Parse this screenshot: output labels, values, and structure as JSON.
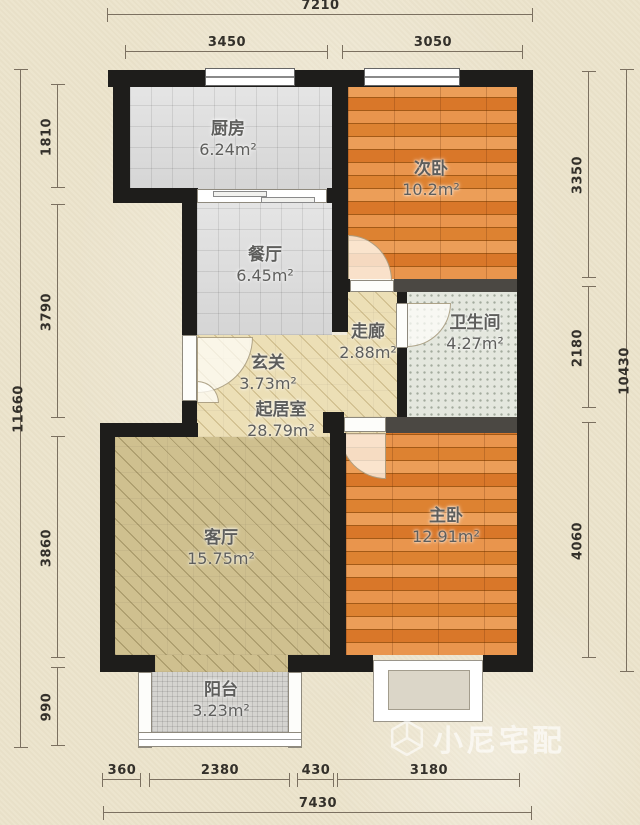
{
  "watermark": {
    "text": "小尼宅配",
    "icon": "cube-logo-icon"
  },
  "rooms": [
    {
      "key": "kitchen",
      "name": "厨房",
      "area": "6.24m²"
    },
    {
      "key": "second-bedroom",
      "name": "次卧",
      "area": "10.2m²"
    },
    {
      "key": "dining",
      "name": "餐厅",
      "area": "6.45m²"
    },
    {
      "key": "corridor",
      "name": "走廊",
      "area": "2.88m²"
    },
    {
      "key": "bathroom",
      "name": "卫生间",
      "area": "4.27m²"
    },
    {
      "key": "entry",
      "name": "玄关",
      "area": "3.73m²"
    },
    {
      "key": "hall",
      "name": "起居室",
      "area": "28.79m²"
    },
    {
      "key": "living",
      "name": "客厅",
      "area": "15.75m²"
    },
    {
      "key": "master-bedroom",
      "name": "主卧",
      "area": "12.91m²"
    },
    {
      "key": "balcony",
      "name": "阳台",
      "area": "3.23m²"
    }
  ],
  "dimensions": {
    "top": {
      "overall": "7210",
      "segments": [
        "3450",
        "3050"
      ]
    },
    "bottom": {
      "overall": "7430",
      "segments": [
        "360",
        "2380",
        "430",
        "3180"
      ]
    },
    "left": {
      "overall": "11660",
      "segments": [
        "1810",
        "3790",
        "3860",
        "990"
      ]
    },
    "right": {
      "overall": "10430",
      "segments": [
        "3350",
        "2180",
        "4060"
      ]
    }
  },
  "colors": {
    "background": "#ece4cd",
    "wall": "#1e1d1b",
    "wall_interior": "#4b4843",
    "wood_floor": "#df8130",
    "tile_floor": "#dcdcdc",
    "hatch_floor": "#ecdfb6",
    "living_floor": "#cfc08f",
    "bath_floor": "#e4e7de",
    "balcony_floor": "#d5d4d0",
    "dimension_text": "#33302a"
  }
}
